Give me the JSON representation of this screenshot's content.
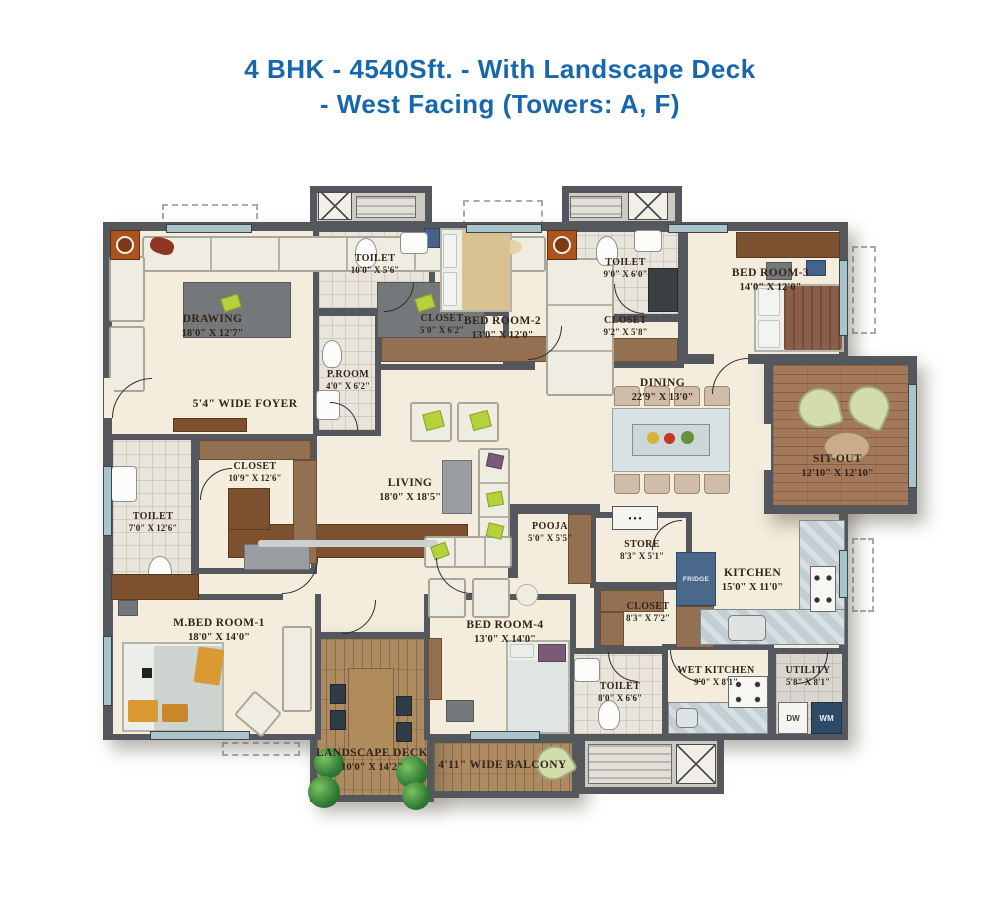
{
  "title": {
    "line1": "4 BHK - 4540Sft. - With Landscape Deck",
    "line2": "- West Facing (Towers: A, F)"
  },
  "colors": {
    "title_blue": "#1767ae",
    "wall_gray": "#54575b",
    "floor_cream": "#f4ecdc",
    "wood_brown": "#a3795a",
    "counter_blue": "#c2ced2"
  },
  "rooms": {
    "drawing": {
      "name": "DRAWING",
      "dims": "18'0\" X 12'7\""
    },
    "foyer": {
      "name": "5'4\" WIDE FOYER"
    },
    "toilet2": {
      "name": "TOILET",
      "dims": "10'0\" X 5'6\""
    },
    "proom": {
      "name": "P.ROOM",
      "dims": "4'0\" X 6'2\""
    },
    "closet2": {
      "name": "CLOSET",
      "dims": "5'0\" X 6'2\""
    },
    "bedroom2": {
      "name": "BED ROOM-2",
      "dims": "13'0\" X 12'0\""
    },
    "toilet3": {
      "name": "TOILET",
      "dims": "9'0\" X 6'0\""
    },
    "closet3": {
      "name": "CLOSET",
      "dims": "9'2\" X 5'8\""
    },
    "bedroom3": {
      "name": "BED ROOM-3",
      "dims": "14'0\" X 12'0\""
    },
    "dining": {
      "name": "DINING",
      "dims": "22'9\" X 13'0\""
    },
    "sitout": {
      "name": "SIT-OUT",
      "dims": "12'10\" X 12'10\""
    },
    "mcloset": {
      "name": "CLOSET",
      "dims": "10'9\" X 12'6\""
    },
    "mtoilet": {
      "name": "TOILET",
      "dims": "7'0\" X 12'6\""
    },
    "living": {
      "name": "LIVING",
      "dims": "18'0\" X 18'5\""
    },
    "pooja": {
      "name": "POOJA",
      "dims": "5'0\" X 5'5\""
    },
    "store": {
      "name": "STORE",
      "dims": "8'3\" X 5'1\""
    },
    "kitchen": {
      "name": "KITCHEN",
      "dims": "15'0\" X 11'0\""
    },
    "mbedroom1": {
      "name": "M.BED ROOM-1",
      "dims": "18'0\" X 14'0\""
    },
    "bedroom4": {
      "name": "BED ROOM-4",
      "dims": "13'0\" X 14'0\""
    },
    "closet4": {
      "name": "CLOSET",
      "dims": "8'3\" X 7'2\""
    },
    "toilet4": {
      "name": "TOILET",
      "dims": "8'0\" X 6'6\""
    },
    "wetkitchen": {
      "name": "WET KITCHEN",
      "dims": "9'0\" X 8'1\""
    },
    "utility": {
      "name": "UTILITY",
      "dims": "5'8\" X 8'1\""
    },
    "deck": {
      "name": "LANDSCAPE DECK",
      "dims": "10'0\" X 14'2\""
    },
    "balcony": {
      "name": "4'11\" WIDE BALCONY"
    }
  },
  "appliances": {
    "fridge": "FRIDGE",
    "dw": "DW",
    "wm": "WM"
  }
}
